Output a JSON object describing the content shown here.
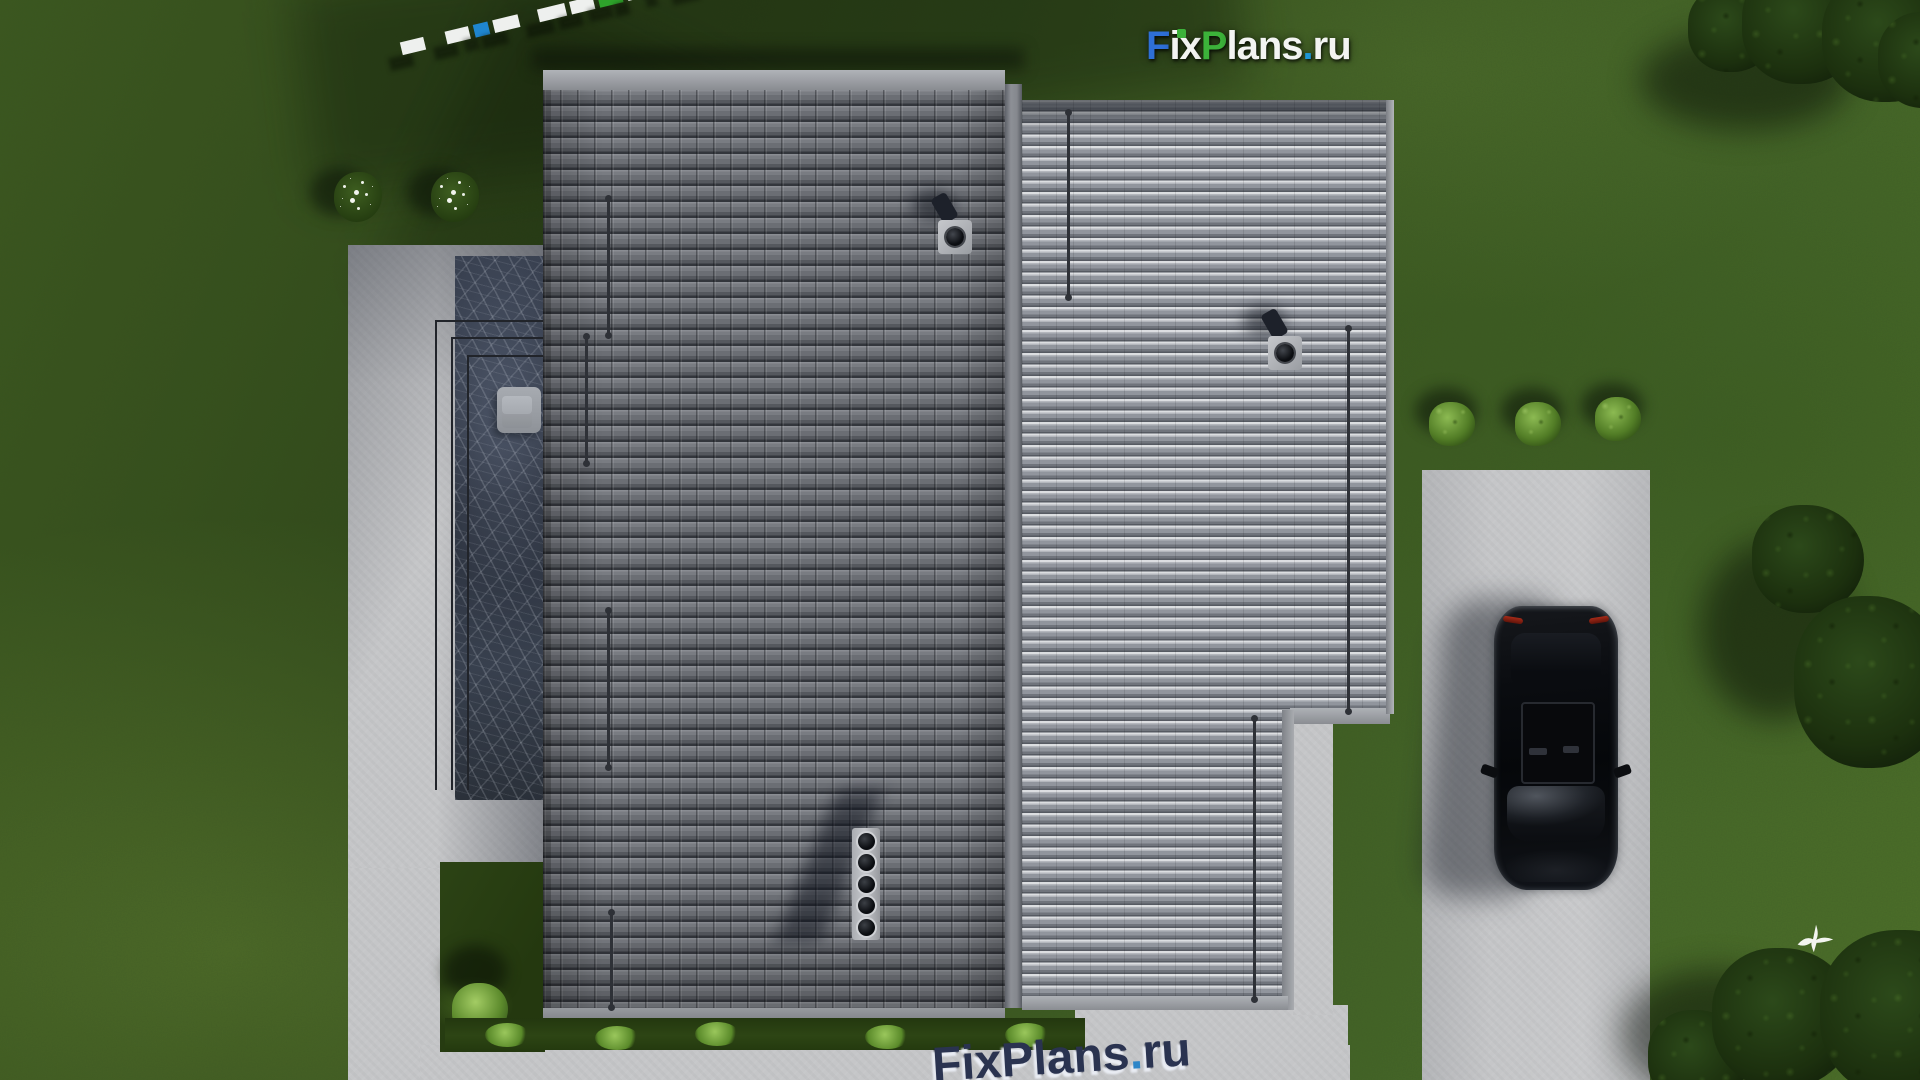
{
  "watermark_top": {
    "text": "FixPlans.ru",
    "parts": {
      "f": "F",
      "ix": "ix",
      "p": "P",
      "lans": "lans",
      "dot": ".",
      "ru": "ru"
    },
    "colors": {
      "f": "#2e6fd6",
      "ix": "#f3f4f2",
      "p": "#3cb23a",
      "lans": "#f3f4f2",
      "dot": "#1f98d8",
      "ru": "#f3f4f2",
      "i_dot": "#3cb23a"
    }
  },
  "watermark_bottom": {
    "text": "FixPlans.ru",
    "text_main": "FixPlans",
    "dot": ".",
    "suffix": "ru",
    "color": "#2a3350",
    "dot_color": "#2e86c8"
  },
  "scale_bar": {
    "segments": [
      "white",
      "white",
      "blue",
      "white",
      "white",
      "white",
      "green",
      "white",
      "green-small",
      "blue-large"
    ],
    "white": "#eef0ee",
    "blue": "#1f86cf",
    "green": "#2ea32b"
  },
  "scene_colors": {
    "grass_base": "#3b5620",
    "grass_dark": "#2c4316",
    "grass_light": "#5d8030",
    "roof_tiles_dark": "#6e7177",
    "roof_metal_light": "#8e929a",
    "concrete": "#c5c6c8",
    "glass_terrace": "#2e3442",
    "car_body": "#0a0c10",
    "tree_foliage": "#1c300e"
  }
}
